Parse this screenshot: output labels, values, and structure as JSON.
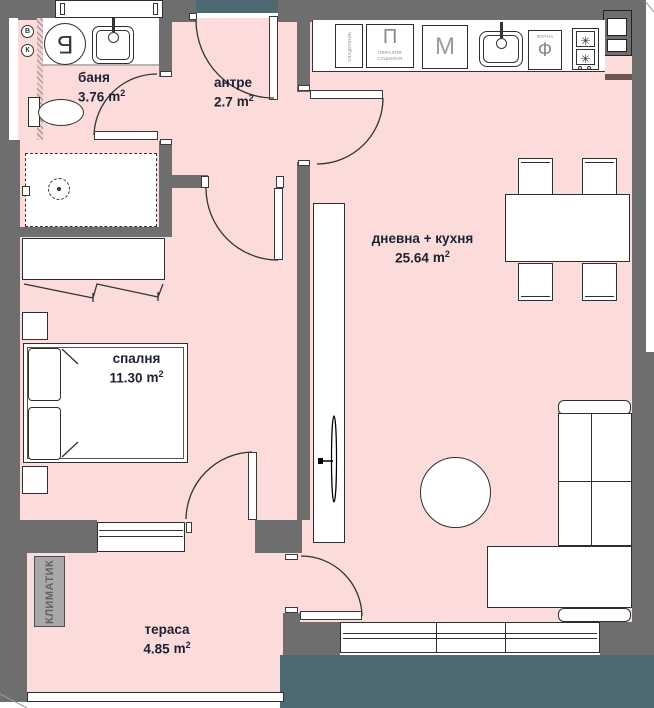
{
  "rooms": [
    {
      "name": "баня",
      "area": "3.76"
    },
    {
      "name": "антре",
      "area": "2.7"
    },
    {
      "name": "дневна + кухня",
      "area": "25.64"
    },
    {
      "name": "спалня",
      "area": "11.30"
    },
    {
      "name": "тераса",
      "area": "4.85"
    }
  ],
  "unit": {
    "symbol": "m",
    "sup": "2"
  },
  "appliances": {
    "fridge": "ХЛАДИЛНИК",
    "washer_abbr": "П",
    "washer_line1": "ПЕРАЛНЯ",
    "washer_line2": "СУШИЛНЯ",
    "dishwasher_abbr": "М",
    "oven_abbr": "Ф",
    "oven_label": "ФУРНА",
    "boiler_abbr": "Б",
    "burner_symbol": "✳",
    "ac_unit": "КЛИМАТИК",
    "riser_water": "В",
    "riser_sewer": "К"
  },
  "colors": {
    "floor": "#fcdcda",
    "wall": "#6e6e6e",
    "slab": "#4d6a73",
    "label_text": "#1c2133",
    "appliance_text": "#8a8a8a",
    "sill": "#6b574e"
  }
}
